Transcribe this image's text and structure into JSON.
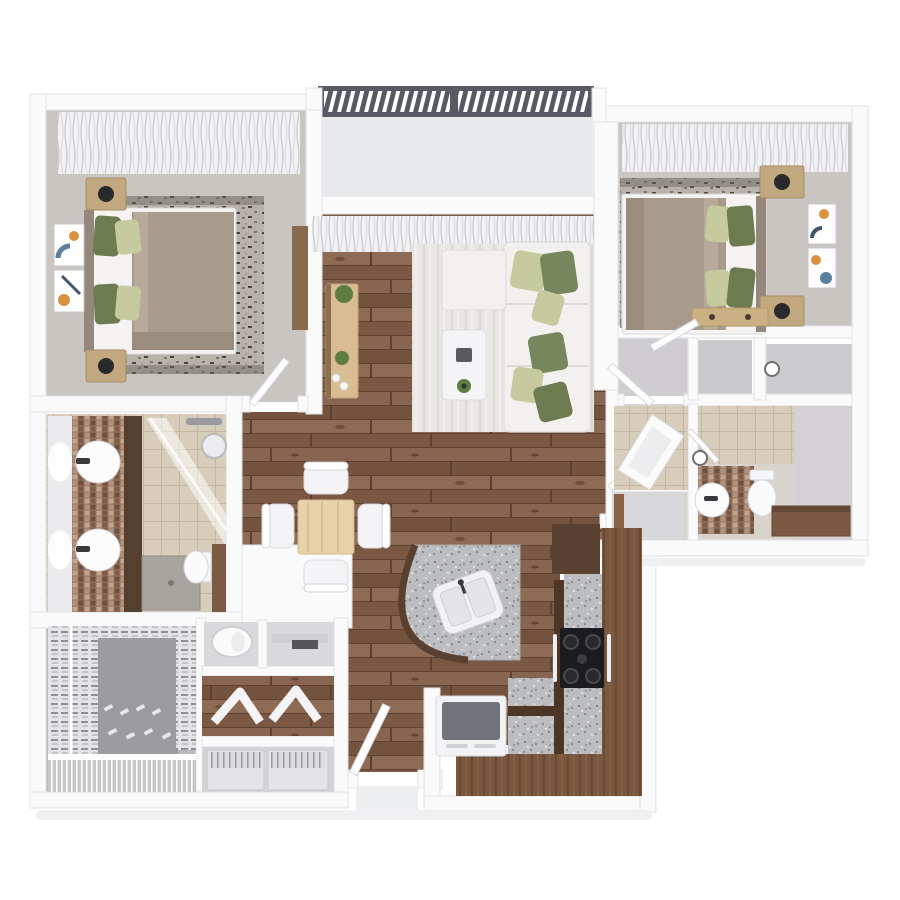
{
  "meta": {
    "title": "3D top-view floor plan, 2 bedroom 2 bathroom apartment with balcony",
    "view": "top-down 3D render",
    "visible_text": "none"
  },
  "palette": {
    "bg": "#ffffff",
    "wall": "#fafafb",
    "wallEdge": "#e3e3e8",
    "bedroomFloor": "#c9c6c2",
    "balconyFloor": "#e7e8ea",
    "railing": "#565a62",
    "woodBase": "#7f5d46",
    "rugLight": "#e9e7e2",
    "rugFleck": "#b7b3ac",
    "sofaWhite": "#f2f1ef",
    "pillowSage": "#6e7b50",
    "pillowGreen": "#77865c",
    "pillowLight": "#c6ca9f",
    "blanket": "#a89b8c",
    "headboard": "#93887b",
    "nightstandWood": "#c2a87f",
    "consoleWood": "#d8bd93",
    "tableWood": "#e8d2ac",
    "tileBeige": "#d8cdbb",
    "mosaic": "#96755f",
    "granite": "#bcbdc0",
    "vanityCabinet": "#55402f",
    "walnut": "#7a573f",
    "walnutDark": "#5a4030",
    "walnutEdge": "#4e3526",
    "stoveBlack": "#1c1c1e",
    "fridgeTop": "#70747a",
    "grayFloor": "#d2d1d3",
    "closetFloor": "#9c9b9e",
    "plantGreen": "#5f7d3f",
    "artBlue": "#5b7f9d",
    "artOrange": "#d9913f",
    "partitionBrown": "#7b5b44",
    "bathCabinet": "#7b5a43",
    "softShadow": "#f0f0f3"
  },
  "rooms": [
    {
      "id": "bedroom-1",
      "position": "top-left",
      "furniture": [
        "double-bed",
        "green-pillows",
        "taupe-blanket",
        "nightstand-x2",
        "black-lamp-x2",
        "flecked-rug",
        "wall-art-x2",
        "dresser",
        "window-curtains",
        "door"
      ]
    },
    {
      "id": "balcony",
      "position": "top-center",
      "furniture": [
        "slatted-railing"
      ]
    },
    {
      "id": "living-room",
      "position": "center-top",
      "furniture": [
        "sectional-sofa",
        "ottoman-chaise",
        "green-pillows",
        "coffee-table",
        "decor-tray",
        "plants",
        "tv-console",
        "area-rug",
        "window-curtains"
      ]
    },
    {
      "id": "bedroom-2",
      "position": "top-right",
      "furniture": [
        "double-bed",
        "green-pillows",
        "taupe-blanket",
        "nightstand-x2",
        "black-lamp-x2",
        "flecked-rug",
        "wall-art-x2",
        "foot-bench",
        "window-curtains",
        "door"
      ]
    },
    {
      "id": "bathroom-1",
      "position": "mid-left",
      "furniture": [
        "double-vanity",
        "mirror",
        "sink-x2",
        "tall-cabinet",
        "glass-shower",
        "shower-head",
        "shower-tray",
        "toilet",
        "privacy-partition"
      ]
    },
    {
      "id": "dining-area",
      "position": "center",
      "furniture": [
        "square-table",
        "chair-x4"
      ]
    },
    {
      "id": "hallway",
      "position": "center-right",
      "furniture": [
        "door-leaves"
      ]
    },
    {
      "id": "closets-row",
      "position": "right-middle",
      "furniture": [
        "vestibule",
        "closet-x2",
        "wall-clock"
      ]
    },
    {
      "id": "bathroom-2",
      "position": "right",
      "furniture": [
        "bathtub",
        "vanity-sink",
        "toilet",
        "storage-cabinet",
        "wall-clock",
        "sub-closet"
      ]
    },
    {
      "id": "kitchen",
      "position": "center-bottom-right",
      "furniture": [
        "curved-island",
        "double-sink",
        "l-shaped-counter",
        "granite-countertop",
        "gas-cooktop",
        "oven-handles",
        "refrigerator",
        "upper-cabinets"
      ]
    },
    {
      "id": "walk-in-closet",
      "position": "bottom-left",
      "furniture": [
        "hanging-clothes-rail-x2",
        "shoe-rows",
        "wire-shelf"
      ]
    },
    {
      "id": "utility-closet",
      "position": "bottom-center",
      "furniture": [
        "water-heater",
        "shelf",
        "ironing-boards",
        "washer",
        "dryer"
      ]
    },
    {
      "id": "entry",
      "position": "bottom-center",
      "furniture": [
        "front-door",
        "landing"
      ]
    }
  ]
}
